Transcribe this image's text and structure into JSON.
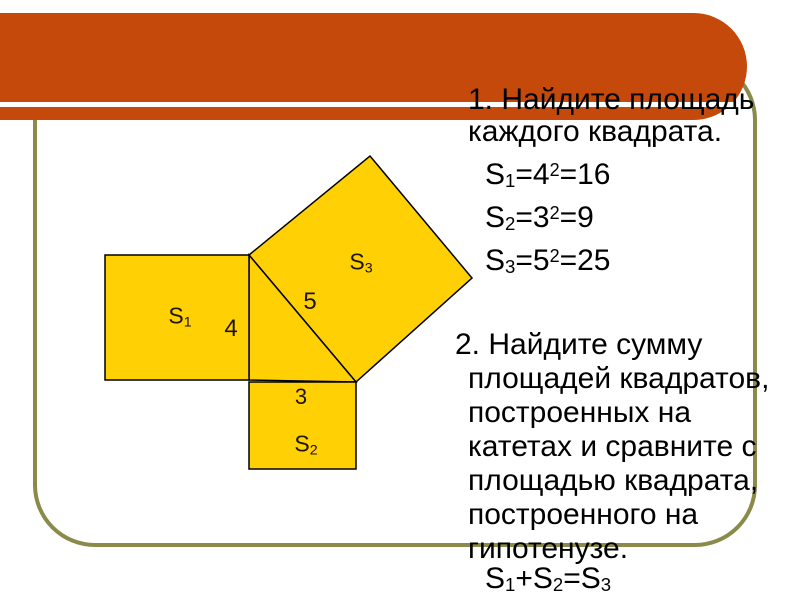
{
  "slide": {
    "colors": {
      "banner": "#C5490B",
      "banner_divider": "#FFFFFF",
      "frame_border": "#8B8A4A",
      "square_fill": "#FFD105",
      "shape_stroke": "#000000",
      "text": "#000000"
    },
    "figure": {
      "square_fill": "#FFD105",
      "labels": {
        "s1": {
          "base": "S",
          "sub": "1"
        },
        "s2": {
          "base": "S",
          "sub": "2"
        },
        "s3": {
          "base": "S",
          "sub": "3"
        },
        "leg_vertical": "4",
        "leg_horizontal": "3",
        "hypotenuse": "5"
      }
    },
    "content": {
      "item1": {
        "lines": [
          "1. Найдите площадь",
          "каждого квадрата."
        ]
      },
      "formulas": [
        {
          "base": "S",
          "sub": "1",
          "eq1": "=4",
          "sup": "2",
          "eq2": "=16"
        },
        {
          "base": "S",
          "sub": "2",
          "eq1": "=3",
          "sup": "2",
          "eq2": "=9"
        },
        {
          "base": "S",
          "sub": "3",
          "eq1": "=5",
          "sup": "2",
          "eq2": "=25"
        }
      ],
      "item2": {
        "lines": [
          "2. Найдите сумму",
          "площадей квадратов,",
          "построенных на",
          "катетах и сравните с",
          "площадью квадрата,",
          "построенного на",
          "гипотенузе."
        ]
      },
      "sum": {
        "a_base": "S",
        "a_sub": "1",
        "plus": "+",
        "b_base": "S",
        "b_sub": "2",
        "eq": "=",
        "c_base": "S",
        "c_sub": "3"
      }
    }
  }
}
